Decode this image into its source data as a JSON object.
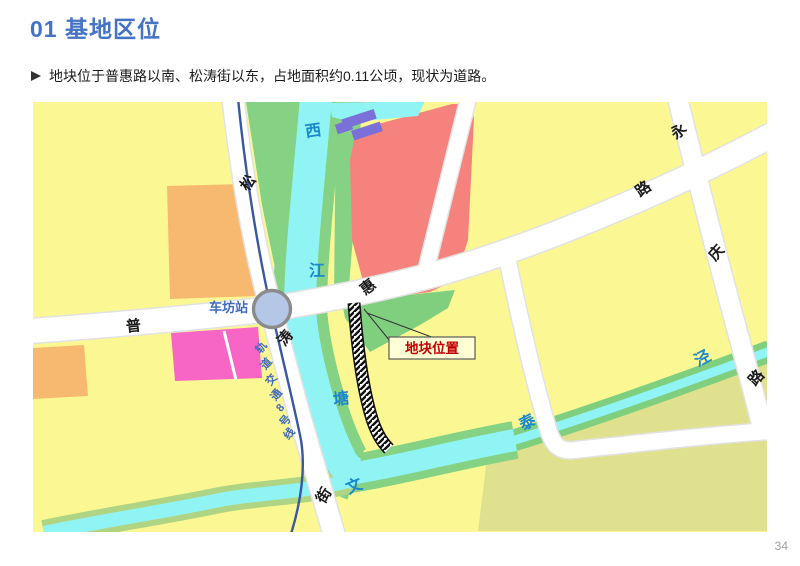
{
  "page": {
    "title": "01 基地区位",
    "bullet": "地块位于普惠路以南、松涛街以东，占地面积约0.11公顷，现状为道路。",
    "page_number": "34"
  },
  "map": {
    "station": "车坊站",
    "metro_line": {
      "full": "轨道交通8号线",
      "chars": [
        "轨",
        "道",
        "交",
        "通",
        "8",
        "号",
        "线"
      ]
    },
    "site_callout": "地块位置",
    "roads": {
      "song": "松",
      "tao": "涛",
      "jie": "街",
      "pu": "普",
      "hui": "惠",
      "lu_east": "路",
      "yong": "永",
      "qing": "庆",
      "lu_south": "路"
    },
    "rivers": {
      "xi": "西",
      "jiang": "江",
      "tang": "塘",
      "wen": "文",
      "tai": "泰",
      "jing": "泾"
    },
    "colors": {
      "parcel_yellow": "#FBF893",
      "parcel_olive": "#DFE18E",
      "parcel_red": "#F5827C",
      "parcel_orange": "#F7B96F",
      "parcel_pink": "#F765C5",
      "green": "#85D285",
      "water": "#90F4F4",
      "road": "#FFFFFF",
      "metro_blue": "#3A57A0",
      "station_fill": "#B4C7E6",
      "purple_building": "#7B6FD8",
      "label_blue": "#4169C0",
      "river_label": "#1B87CC",
      "site_red": "#C00000",
      "title_blue": "#4472C4"
    }
  }
}
